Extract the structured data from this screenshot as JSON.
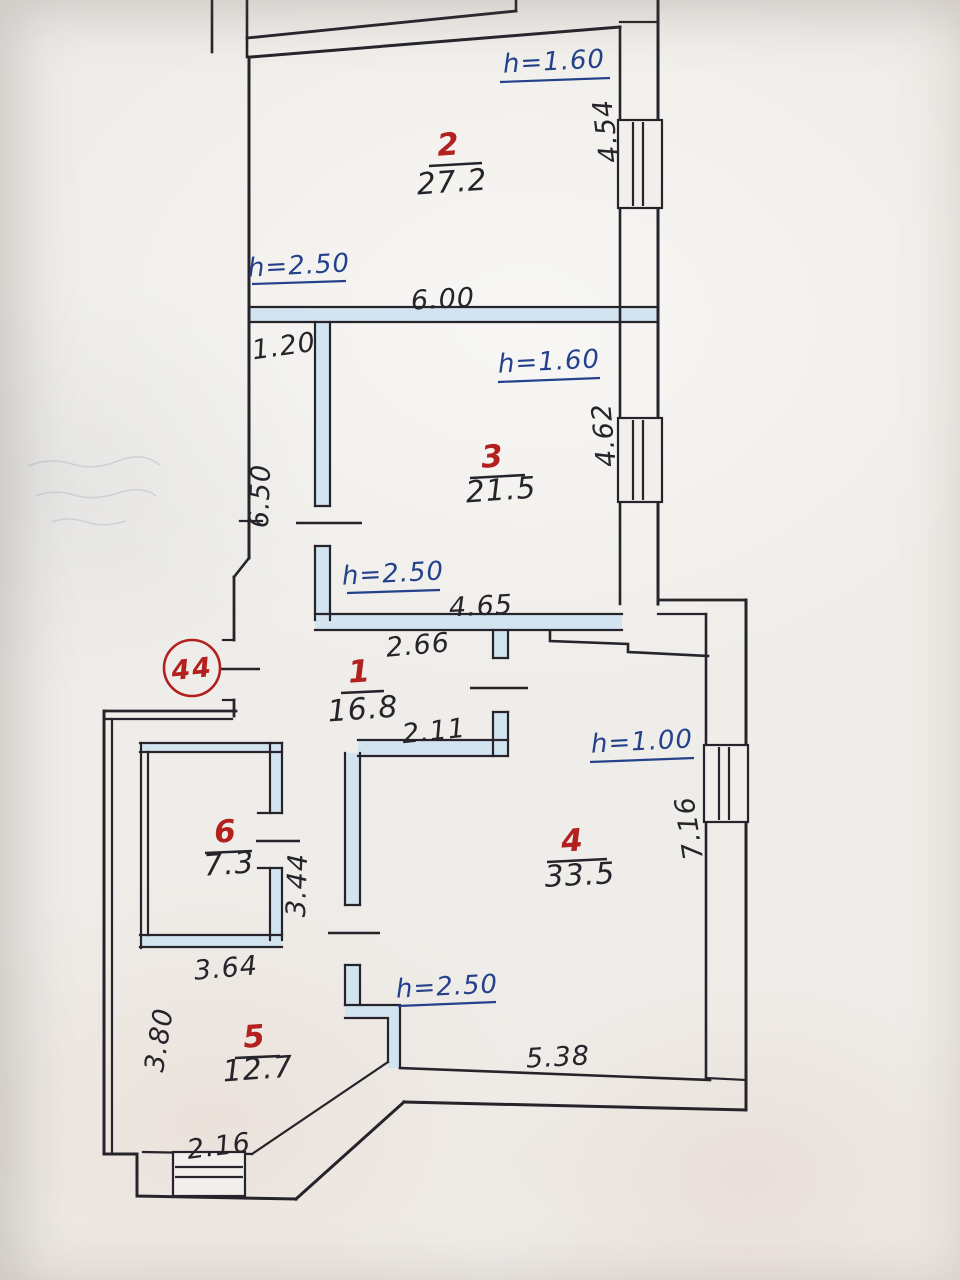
{
  "colors": {
    "ink": "#26242a",
    "red_accent": "#b3211f",
    "blue_ink": "#24418c",
    "wall_fill_blue": "#d3e4f1",
    "paper": "#efede9"
  },
  "plan": {
    "unit_circle": "44",
    "rooms": {
      "r1": {
        "number": "1",
        "area": "16.8"
      },
      "r2": {
        "number": "2",
        "area": "27.2"
      },
      "r3": {
        "number": "3",
        "area": "21.5"
      },
      "r4": {
        "number": "4",
        "area": "33.5"
      },
      "r5": {
        "number": "5",
        "area": "12.7"
      },
      "r6": {
        "number": "6",
        "area": "7.3"
      }
    },
    "heights": {
      "room2_upper": "h=1.60",
      "room2_lower": "h=2.50",
      "room3_upper": "h=1.60",
      "room3_lower": "h=2.50",
      "room4_upper": "h=1.00",
      "room4_lower": "h=2.50"
    },
    "dims": {
      "room2_width": "6.00",
      "room2_right": "4.54",
      "strip_width": "1.20",
      "strip_height": "6.50",
      "room3_right": "4.62",
      "room3_width": "4.65",
      "hall_top": "2.66",
      "hall_bottom": "2.11",
      "room4_right": "7.16",
      "room4_bottom": "5.38",
      "room6_right": "3.44",
      "room6_bottom": "3.64",
      "room5_left": "3.80",
      "room5_bottom": "2.16"
    }
  }
}
